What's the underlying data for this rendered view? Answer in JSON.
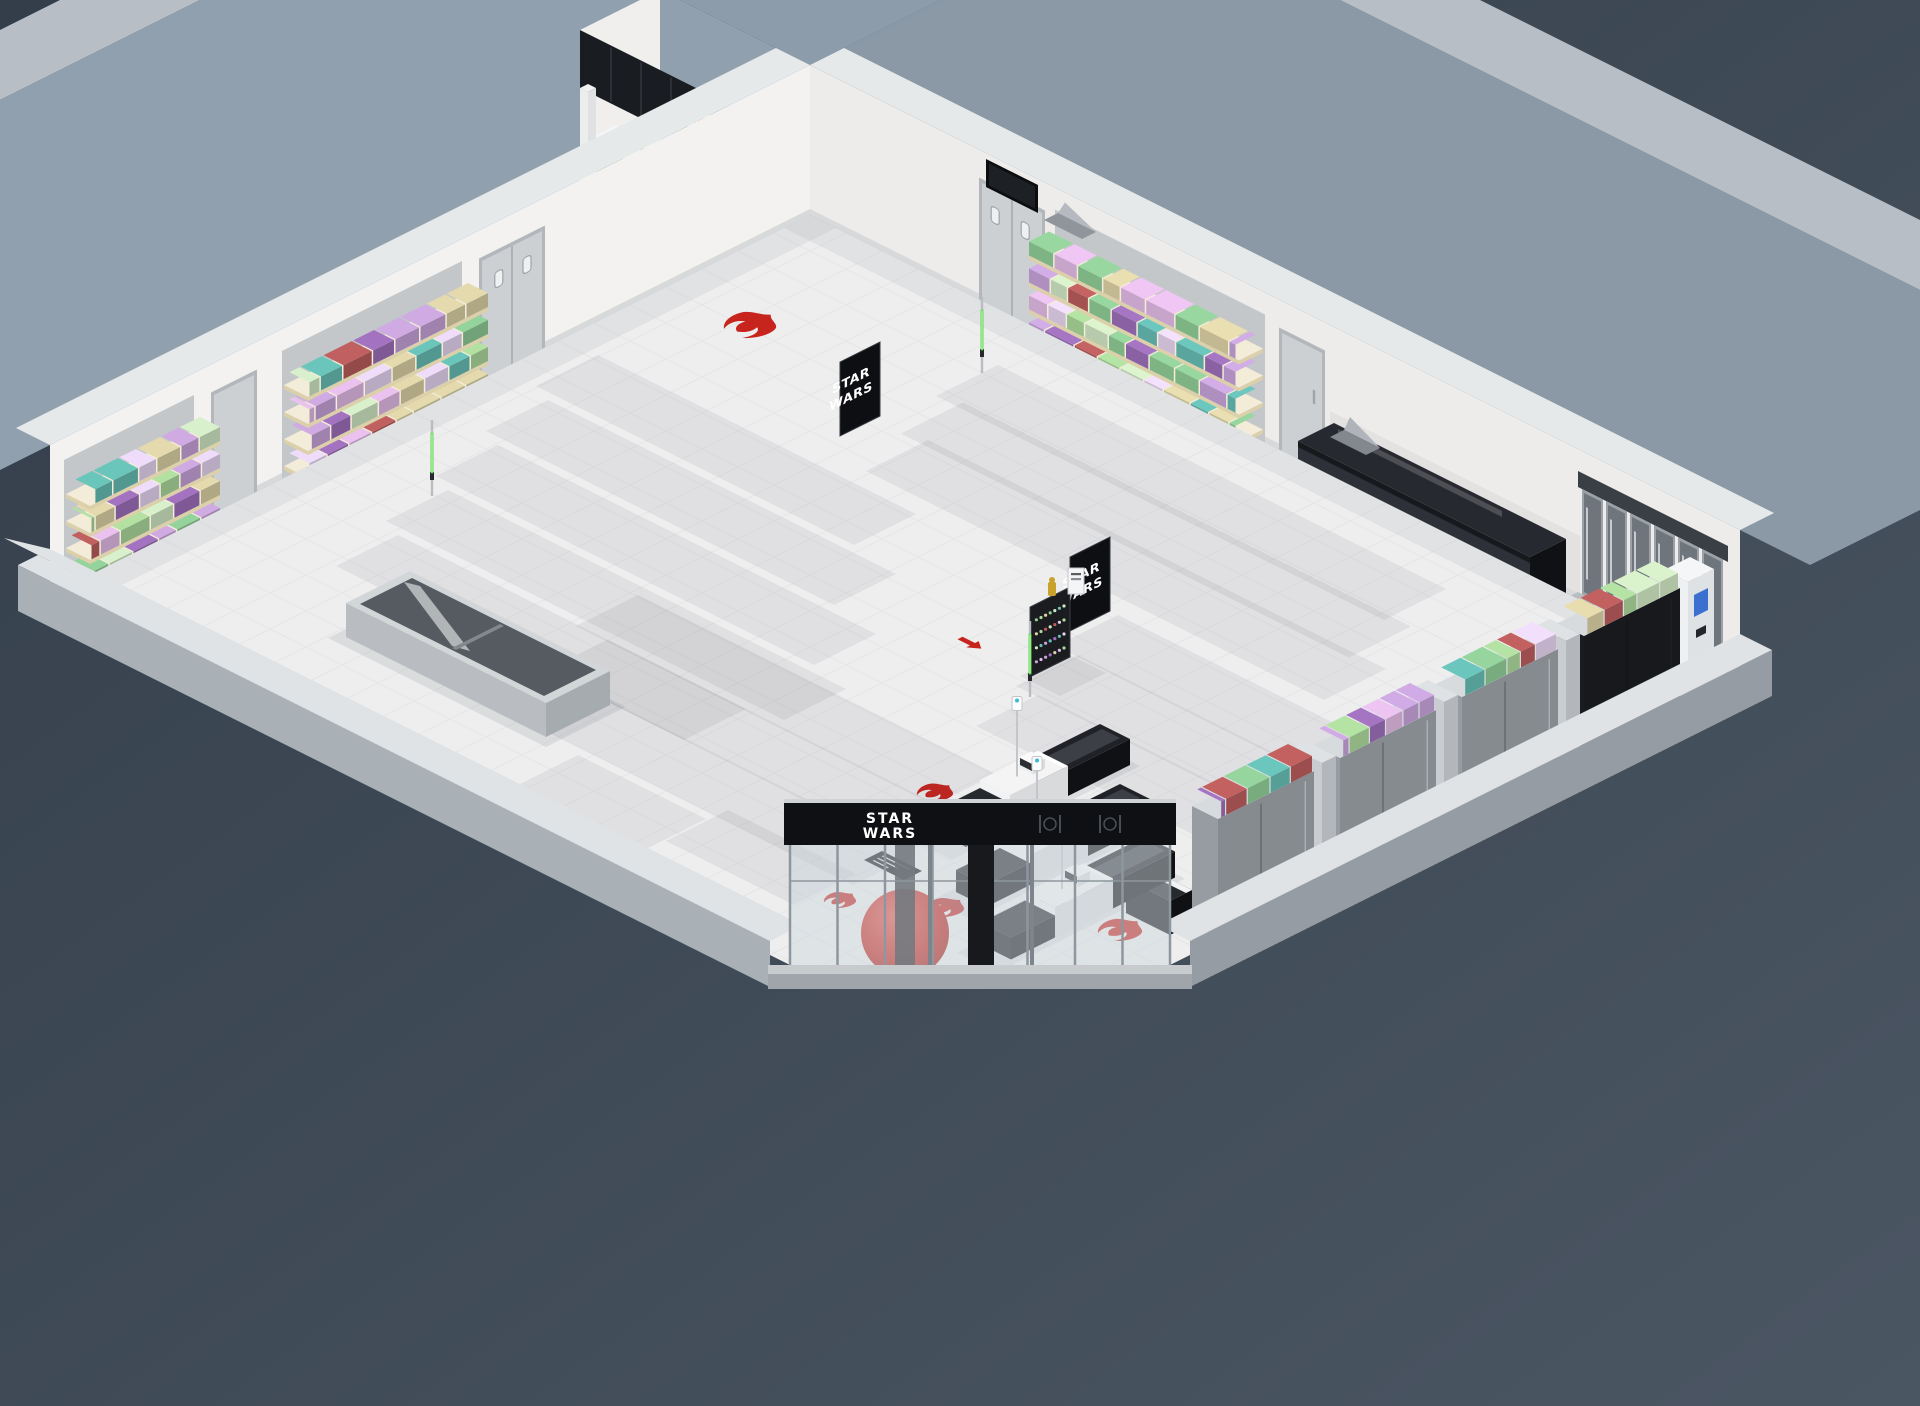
{
  "scene": {
    "background_top": "#333e4a",
    "background_bottom": "#4b5663",
    "room": {
      "floor": "#eeeeef",
      "tile_line": "#e4e5e7",
      "far_wall_nw": "#f3f2f0",
      "far_wall_ne": "#edecea",
      "wall_cap": "#e6e9ea",
      "near_wall_cap": "#e0e3e5",
      "near_wall_face_sw": "#a9b0b6",
      "near_wall_face_se": "#959ca4",
      "outer_margin_nw": "#90a0ae",
      "outer_margin_ne": "#8b99a7",
      "outer_corner": "#8d9caa",
      "outer_bevel": "#b7bec5",
      "baseboard": "#d8d9da",
      "alcove_shadow": "#e3e2e0"
    }
  },
  "brand": {
    "wordmark": [
      "STAR",
      "WARS"
    ]
  },
  "entrance": {
    "glass": "rgba(205,215,221,0.5)",
    "band": "#0f1013",
    "band_cap": "#cfd3d6",
    "mullion": "#8e979e",
    "door_frame": "#7c858c",
    "column": "#17191c",
    "sphere": "#c3251d",
    "sill": "#c7cbce",
    "apron": "#9fa5ab"
  },
  "decals": {
    "rebel_color": "#c7241e",
    "rebel_count": 5,
    "imperial_color": "#101113",
    "imperial_count": 1,
    "arrow_color": "#c7241e"
  },
  "shelving": {
    "palette": [
      "#c7a3da",
      "#e6d4f0",
      "#abd89c",
      "#66bdb4",
      "#ba5c5c",
      "#dcd2a6",
      "#9d6fba",
      "#d0e7c3",
      "#e2bbe6",
      "#8fcb96"
    ],
    "board_top": "#f2ecd8",
    "board_side": "#dbd0a9",
    "frame": "#c6cacf",
    "base": "#9aa0a6",
    "endcap": "#c9cdd1",
    "back_panel": "#c3c7ca",
    "bay_back": "#868b90",
    "bay_back_dark": "#17191d",
    "bay_pillar": "#c9cdd1"
  },
  "fixtures": {
    "gondola_count": 16,
    "checkout_lanes": 3,
    "freezer_doors": 6,
    "dark_case": "#17191d",
    "service_band": "#191c21",
    "cooler_body": "#b9bdc1",
    "cooler_interior": "#565b61",
    "mat": "#121316",
    "door": "#cdd0d3",
    "tv": "#0c0d0f",
    "gold_figure": "#c9a22b",
    "saber_blade": "#59d84a",
    "model_gray": "#9aa0a5",
    "counter_white": "#f1f2f3",
    "counter_black": "#17181b"
  }
}
